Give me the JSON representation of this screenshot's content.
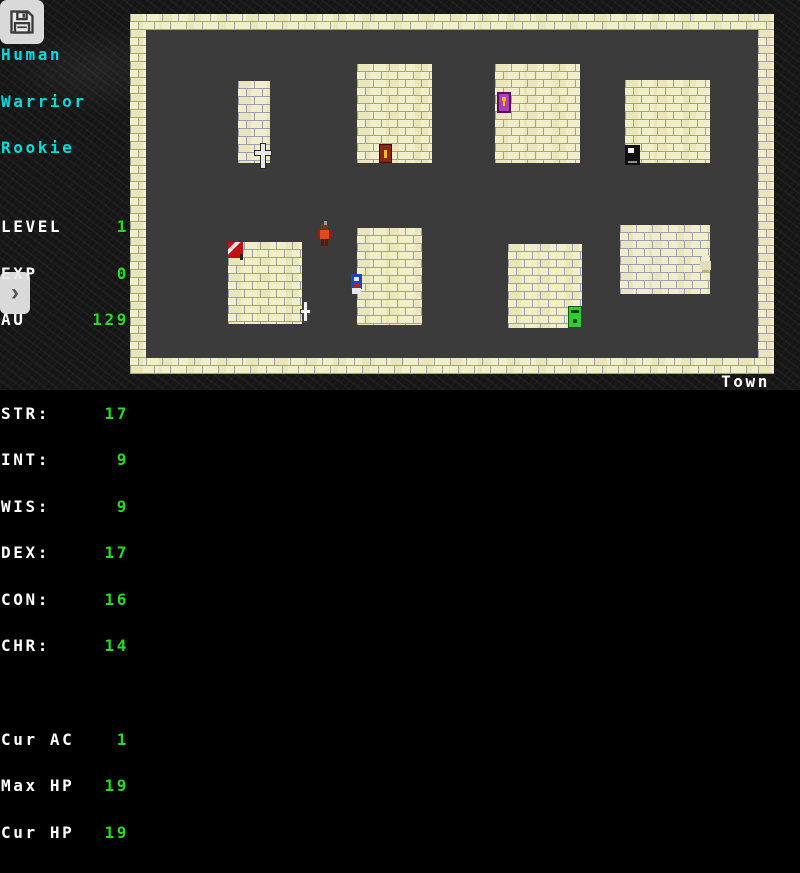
{
  "colors": {
    "cyan": "#00dcdc",
    "white": "#ffffff",
    "green": "#22dd22",
    "brick": "#f2eec9",
    "mortar": "#9aa0ac",
    "floor": "#3b3b3b"
  },
  "hud": {
    "save_button_icon": "floppy-disk",
    "expand_button_glyph": "›"
  },
  "sidebar": {
    "race": "Human",
    "class": "Warrior",
    "title": "Rookie",
    "progress": [
      {
        "label": "LEVEL",
        "value": "1"
      },
      {
        "label": "EXP",
        "value": "0"
      },
      {
        "label": "AU",
        "value": "129"
      }
    ],
    "stats": [
      {
        "label": "STR:",
        "value": "17"
      },
      {
        "label": "INT:",
        "value": "9"
      },
      {
        "label": "WIS:",
        "value": "9"
      },
      {
        "label": "DEX:",
        "value": "17"
      },
      {
        "label": "CON:",
        "value": "16"
      },
      {
        "label": "CHR:",
        "value": "14"
      }
    ],
    "vitals": [
      {
        "label": "Cur AC",
        "value": "1"
      },
      {
        "label": "Max HP",
        "value": "19"
      },
      {
        "label": "Cur HP",
        "value": "19"
      }
    ]
  },
  "map": {
    "location_label": "Town",
    "buildings": [
      {
        "x": 108,
        "y": 67,
        "w": 32,
        "h": 82
      },
      {
        "x": 227,
        "y": 50,
        "w": 75,
        "h": 99
      },
      {
        "x": 365,
        "y": 50,
        "w": 85,
        "h": 99
      },
      {
        "x": 495,
        "y": 66,
        "w": 85,
        "h": 83
      },
      {
        "x": 98,
        "y": 228,
        "w": 74,
        "h": 82
      },
      {
        "x": 227,
        "y": 214,
        "w": 65,
        "h": 97
      },
      {
        "x": 378,
        "y": 230,
        "w": 74,
        "h": 84
      },
      {
        "x": 490,
        "y": 211,
        "w": 90,
        "h": 69
      }
    ],
    "sprites": [
      {
        "type": "sword-sign",
        "name": "sword-sign-sprite",
        "x": 123,
        "y": 129
      },
      {
        "type": "door-brown",
        "name": "brown-door-sprite",
        "x": 249,
        "y": 130
      },
      {
        "type": "door-purple",
        "name": "purple-door-sprite",
        "x": 367,
        "y": 78
      },
      {
        "type": "door-black",
        "name": "black-door-sprite",
        "x": 495,
        "y": 131
      },
      {
        "type": "flag-red",
        "name": "red-flag-sign-sprite",
        "x": 98,
        "y": 228
      },
      {
        "type": "player",
        "name": "player-sprite",
        "x": 187,
        "y": 207
      },
      {
        "type": "npc-blue",
        "name": "blue-npc-sprite",
        "x": 220,
        "y": 260
      },
      {
        "type": "dagger-white",
        "name": "dagger-sign-sprite",
        "x": 168,
        "y": 288
      },
      {
        "type": "door-green",
        "name": "green-door-sprite",
        "x": 438,
        "y": 292
      },
      {
        "type": "npc-white",
        "name": "white-npc-sprite",
        "x": 569,
        "y": 240
      }
    ]
  }
}
